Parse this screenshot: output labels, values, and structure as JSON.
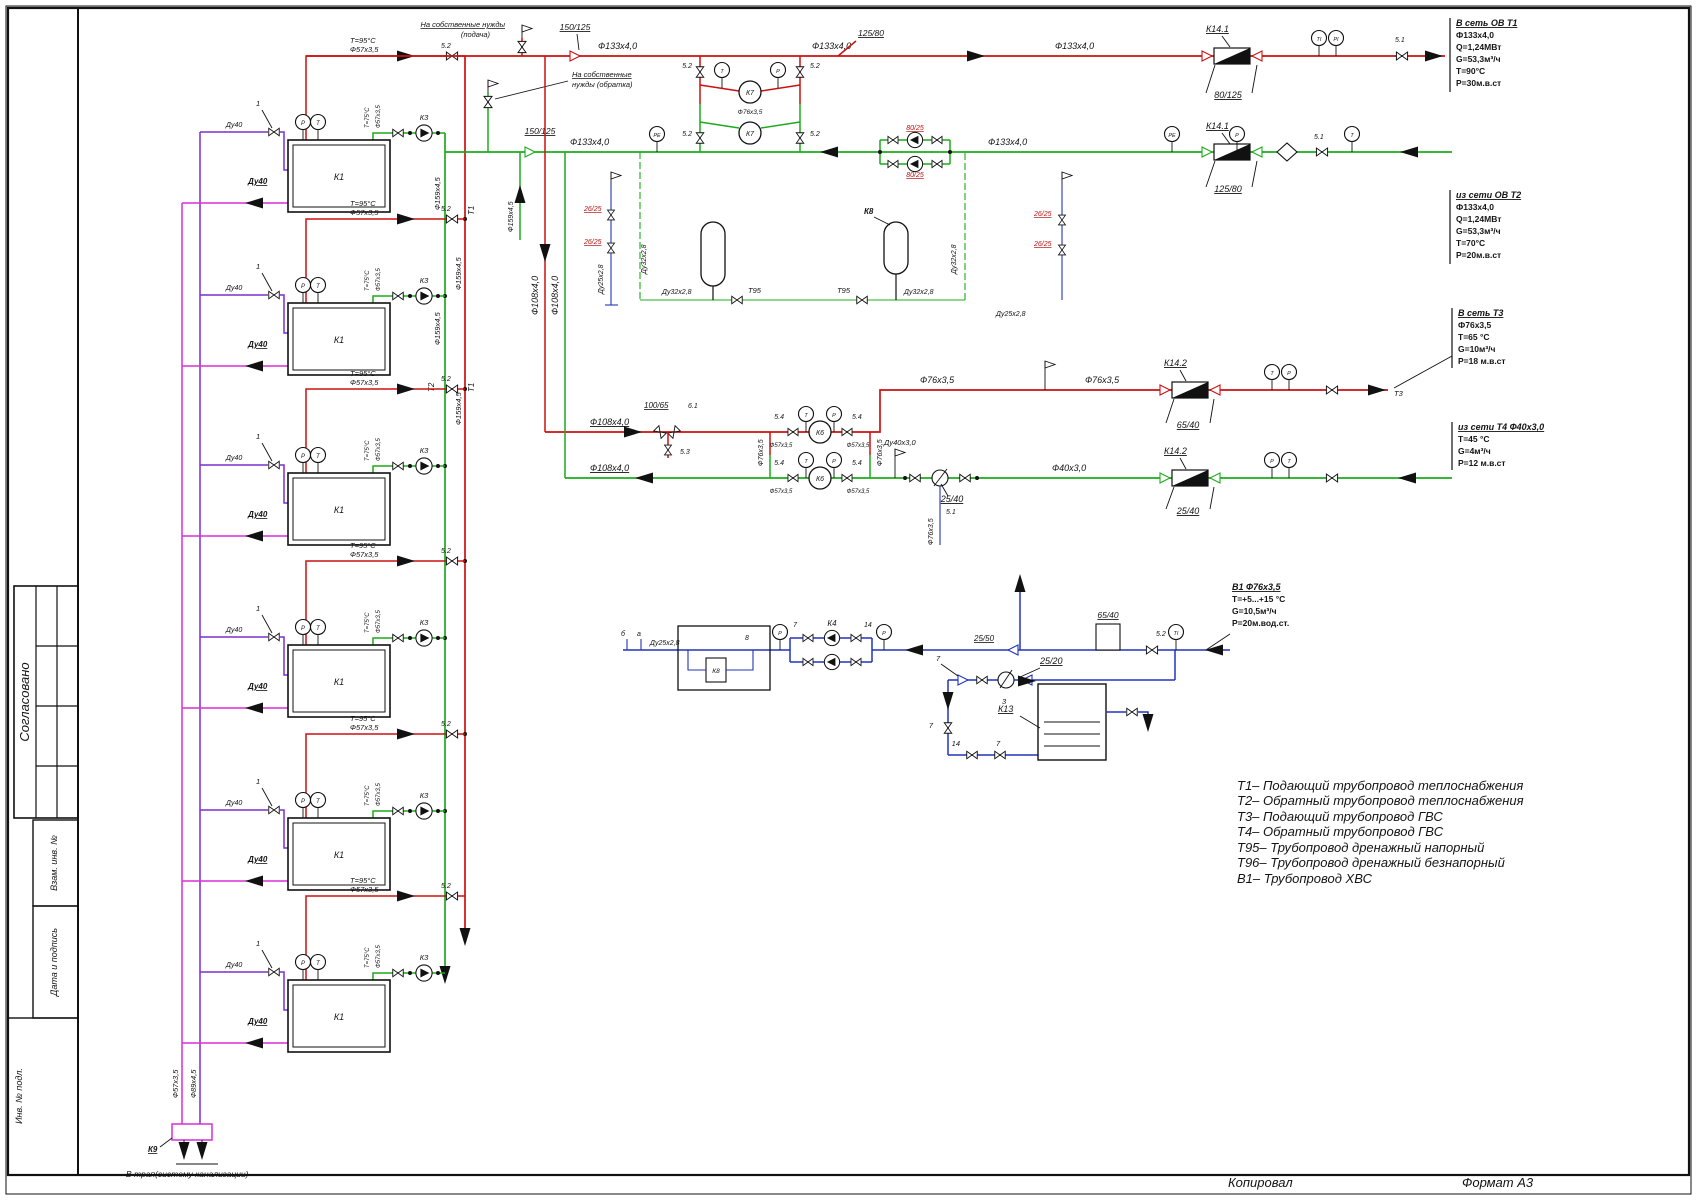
{
  "page": {
    "footer": {
      "copied": "Копировал",
      "format": "Формат А3"
    }
  },
  "titleblock": {
    "approved": "Согласовано",
    "vzam": "Взам. инв. №",
    "datepod": "Дата и подпись",
    "inv": "Инв. № подл."
  },
  "legend": [
    "Т1– Подающий трубопровод теплоснабжения",
    "Т2– Обратный трубопровод теплоснабжения",
    "Т3– Подающий трубопровод  ГВС",
    "Т4– Обратный трубопровод  ГВС",
    "Т95– Трубопровод дренажный напорный",
    "Т96– Трубопровод дренажный безнапорный",
    "В1– Трубопровод ХВС"
  ],
  "annotations": {
    "t1": {
      "title": "В сеть ОВ Т1",
      "l1": "Ф133х4,0",
      "l2": "Q=1,24МВт",
      "l3": "G=53,3м³/ч",
      "l4": "Т=90°С",
      "l5": "Р=30м.в.ст"
    },
    "t2": {
      "title": "из сети ОВ Т2",
      "l1": "Ф133х4,0",
      "l2": "Q=1,24МВт",
      "l3": "G=53,3м³/ч",
      "l4": "Т=70°С",
      "l5": "Р=20м.в.ст"
    },
    "t3": {
      "title": "В сеть Т3",
      "l1": "Ф76х3,5",
      "l2": "Т=65 °С",
      "l3": "G=10м³/ч",
      "l4": "Р=18 м.в.ст"
    },
    "t4": {
      "title": "из сети Т4 Ф40х3,0",
      "l1": "Т=45 °С",
      "l2": "G=4м³/ч",
      "l3": "Р=12 м.в.ст"
    },
    "b1": {
      "title": "В1 Ф76х3,5",
      "l1": "Т=+5...+15 °С",
      "l2": "G=10,5м³/ч",
      "l3": "Р=20м.вод.ст."
    }
  },
  "notes": {
    "own_supply_1": "На собственные нужды",
    "own_supply_2": "(подача)",
    "own_return_1": "На собственные",
    "own_return_2": "нужды (обратка)",
    "to_drain": "В трап(систему канализации)"
  },
  "buildings": [
    {
      "name": "К1",
      "pump": "К3",
      "tag": "1",
      "valve": "5.2",
      "supply_temp": "Т=95°С",
      "supply_pipe": "Ф57х3,5",
      "return_temp": "Т=75°С",
      "return_pipe": "Ф57х3,5",
      "drain": "Ду40",
      "drain2": "Ду40"
    },
    {
      "name": "К1",
      "pump": "К3",
      "tag": "1",
      "valve": "5.2",
      "supply_temp": "Т=95°С",
      "supply_pipe": "Ф57х3,5",
      "return_temp": "Т=75°С",
      "return_pipe": "Ф57х3,5",
      "drain": "Ду40",
      "drain2": "Ду40"
    },
    {
      "name": "К1",
      "pump": "К3",
      "tag": "1",
      "valve": "5.2",
      "supply_temp": "Т=95°С",
      "supply_pipe": "Ф57х3,5",
      "return_temp": "Т=75°С",
      "return_pipe": "Ф57х3,5",
      "drain": "Ду40",
      "drain2": "Ду40"
    },
    {
      "name": "К1",
      "pump": "К3",
      "tag": "1",
      "valve": "5.2",
      "supply_temp": "Т=95°С",
      "supply_pipe": "Ф57х3,5",
      "return_temp": "Т=75°С",
      "return_pipe": "Ф57х3,5",
      "drain": "Ду40",
      "drain2": "Ду40"
    },
    {
      "name": "К1",
      "pump": "К3",
      "tag": "1",
      "valve": "5.2",
      "supply_temp": "Т=95°С",
      "supply_pipe": "Ф57х3,5",
      "return_temp": "Т=75°С",
      "return_pipe": "Ф57х3,5",
      "drain": "Ду40",
      "drain2": "Ду40"
    },
    {
      "name": "К1",
      "pump": "К3",
      "tag": "1",
      "valve": "5.2",
      "supply_temp": "Т=95°С",
      "supply_pipe": "Ф57х3,5",
      "return_temp": "Т=75°С",
      "return_pipe": "Ф57х3,5",
      "drain": "Ду40",
      "drain2": "Ду40"
    }
  ],
  "equipment": {
    "k1": "К1",
    "k3": "К3",
    "k4": "К4",
    "k6": "К6",
    "k7": "К7",
    "k8": "К8",
    "k9": "К9",
    "k13": "К13",
    "k141": "К14.1",
    "k142": "К14.2"
  },
  "reducers": {
    "r150125": "150/125",
    "r80125": "80/125",
    "r12580": "125/80",
    "r10065": "100/65",
    "r6540": "65/40",
    "r2540": "25/40",
    "r2520": "25/20",
    "r2550": "25/50",
    "r8025": "80/25",
    "r2625": "26/25"
  },
  "pipes": {
    "f133": "Ф133х4,0",
    "f159": "Ф159х4,5",
    "f108": "Ф108х4,0",
    "f76": "Ф76х3,5",
    "f57": "Ф57х3,5",
    "f89": "Ф89х4,5",
    "f40": "Ф40х3,0",
    "du40": "Ду40",
    "du403": "Ду40х3,0",
    "du32": "Ду32х2,8",
    "du25": "Ду25х2,8"
  },
  "linenames": {
    "t1": "Т1",
    "t2": "Т2",
    "t3": "Т3",
    "t95": "Т95"
  },
  "valves": {
    "v52": "5.2",
    "v54": "5.4",
    "v53": "5.3",
    "v51": "5.1",
    "v61": "6.1",
    "v1": "1",
    "v3": "3",
    "v7": "7",
    "v14": "14",
    "v8": "8",
    "va": "а",
    "vb": "б"
  },
  "gauges": {
    "t": "Т",
    "p": "Р",
    "ti": "ТI",
    "pi": "РI",
    "pe": "РЕ"
  },
  "colors": {
    "supply": "#cc1111",
    "return": "#1cab1c",
    "cold": "#2233bb",
    "drain_pressure": "#7a2fd0",
    "drain_gravity": "#d92fd9",
    "ink": "#111111"
  }
}
